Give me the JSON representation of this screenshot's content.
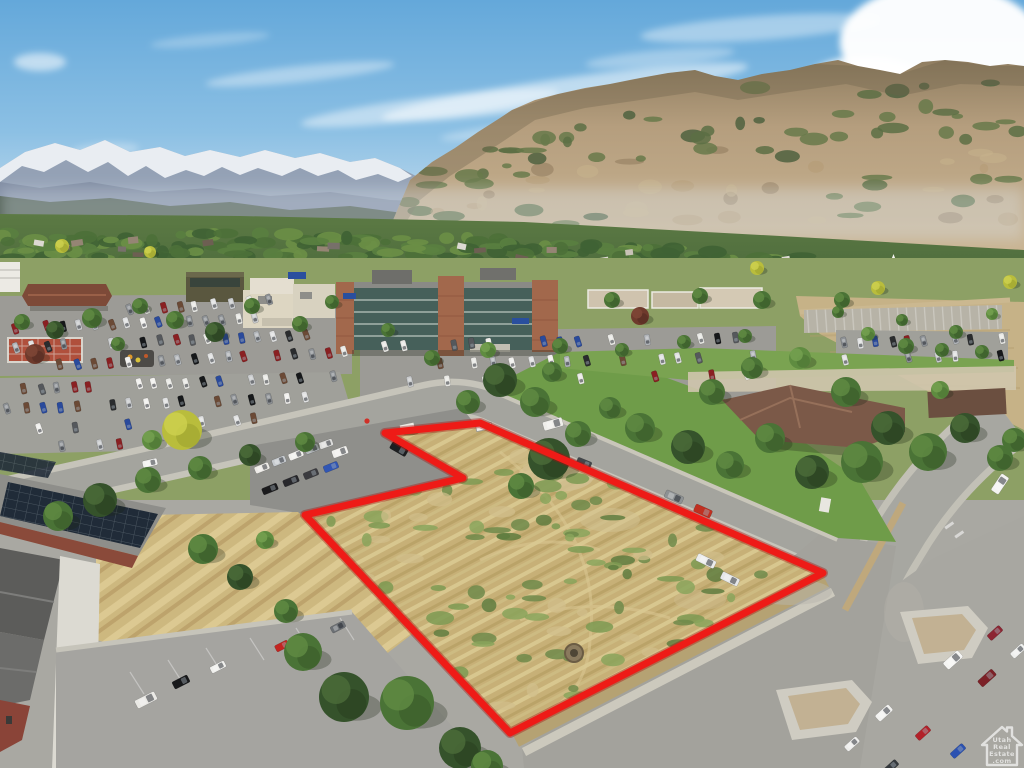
{
  "scene": {
    "kind": "aerial-drone-real-estate-photo",
    "boundary": {
      "color": "#ee1b17",
      "under_color": "#a51210",
      "stroke_width": 7,
      "points_str": "385,433 480,423 823,573 510,733 305,515 463,478"
    },
    "watermark": {
      "icon": "mls-house-watermark-icon",
      "lines": [
        "Utah",
        "Real",
        "Estate",
        ".com"
      ],
      "color": "#ffffff",
      "opacity": 0.66
    },
    "palette": {
      "sky_top": "#64a8da",
      "sky_horizon": "#cfe2ef",
      "cloud": "#ffffff",
      "snow": "#edf1f6",
      "rock_far": "#94a1b5",
      "forest_base": "#4b5a4e",
      "mtn_tan_hi": "#c9b492",
      "mtn_tan_lo": "#9b8466",
      "mtn_green": "#5f7247",
      "valley_green": "#4e6c3c",
      "lawn": "#6f9c49",
      "pavement": "#a5a4a0",
      "pavement_dark": "#8f8f8b",
      "sidewalk": "#cac8bc",
      "field_tan": "#c6b287",
      "parcel_tan": "#c7b077",
      "brick": "#a2684c",
      "beige": "#ddd6c2",
      "glass": "#46605a",
      "roof_brown": "#7b5948",
      "solar": "#202b38",
      "brick_red": "#8a4a3a",
      "plaza_red": "#b0503c",
      "boundary_red": "#ee1b17"
    },
    "clouds": [
      {
        "x": 300,
        "y": 74,
        "rx": 95,
        "ry": 8,
        "o": 0.38,
        "rot": -6
      },
      {
        "x": 430,
        "y": 108,
        "rx": 130,
        "ry": 11,
        "o": 0.45,
        "rot": -7
      },
      {
        "x": 565,
        "y": 92,
        "rx": 185,
        "ry": 14,
        "o": 0.5,
        "rot": -8
      },
      {
        "x": 660,
        "y": 58,
        "rx": 75,
        "ry": 8,
        "o": 0.32,
        "rot": -5
      },
      {
        "x": 520,
        "y": 130,
        "rx": 80,
        "ry": 7,
        "o": 0.3,
        "rot": -6
      },
      {
        "x": 760,
        "y": 28,
        "rx": 120,
        "ry": 12,
        "o": 0.4,
        "rot": -4
      },
      {
        "x": 40,
        "y": 62,
        "rx": 26,
        "ry": 9,
        "o": 0.55,
        "rot": 0
      },
      {
        "x": 105,
        "y": 150,
        "rx": 34,
        "ry": 7,
        "o": 0.28,
        "rot": -4
      },
      {
        "x": 210,
        "y": 40,
        "rx": 60,
        "ry": 6,
        "o": 0.25,
        "rot": -5
      },
      {
        "x": 940,
        "y": 42,
        "rx": 100,
        "ry": 58,
        "o": 0.97,
        "rot": 0
      },
      {
        "x": 866,
        "y": 98,
        "rx": 72,
        "ry": 42,
        "o": 0.92,
        "rot": 0
      },
      {
        "x": 1002,
        "y": 112,
        "rx": 64,
        "ry": 38,
        "o": 0.9,
        "rot": 0
      },
      {
        "x": 918,
        "y": 136,
        "rx": 84,
        "ry": 30,
        "o": 0.85,
        "rot": 0
      },
      {
        "x": 760,
        "y": 150,
        "rx": 60,
        "ry": 9,
        "o": 0.22,
        "rot": -4
      }
    ],
    "valley": {
      "seed": 7,
      "clump_count": 240,
      "roof_count": 26
    },
    "mountain_texture": {
      "seed": 11,
      "count": 95
    },
    "parcel_scrub": {
      "seed": 5,
      "count": 95
    },
    "parking_lots": [
      {
        "seed": 3,
        "fill": 0.8,
        "len": 11,
        "wid": 5.5,
        "slant": -14,
        "rows": [
          [
            15,
            328,
            255,
            318,
            16
          ],
          [
            15,
            347,
            305,
            335,
            19
          ],
          [
            60,
            365,
            345,
            352,
            18
          ],
          [
            130,
            310,
            180,
            306,
            4
          ],
          [
            195,
            306,
            268,
            300,
            5
          ]
        ]
      },
      {
        "seed": 8,
        "fill": 0.75,
        "len": 11,
        "wid": 5.5,
        "slant": -12,
        "rows": [
          [
            25,
            389,
            332,
            377,
            20
          ],
          [
            8,
            409,
            305,
            397,
            18
          ],
          [
            40,
            429,
            255,
            419,
            13
          ],
          [
            2,
            449,
            120,
            443,
            7
          ]
        ]
      },
      {
        "seed": 13,
        "fill": 0.55,
        "len": 11,
        "wid": 5.5,
        "slant": -12,
        "rows": [
          [
            385,
            346,
            752,
            337,
            22
          ],
          [
            420,
            364,
            772,
            356,
            20
          ],
          [
            392,
            383,
            748,
            375,
            20
          ]
        ]
      },
      {
        "seed": 21,
        "fill": 0.62,
        "len": 11,
        "wid": 5.5,
        "slant": -10,
        "rows": [
          [
            845,
            343,
            1002,
            338,
            11
          ],
          [
            845,
            359,
            1002,
            355,
            11
          ]
        ]
      }
    ],
    "vehicles": [
      {
        "x": 262,
        "y": 468,
        "a": -22,
        "l": 15,
        "w": 7,
        "c": "#eceae6"
      },
      {
        "x": 279,
        "y": 461,
        "a": -22,
        "l": 14,
        "w": 7,
        "c": "#c6cace"
      },
      {
        "x": 296,
        "y": 455,
        "a": -22,
        "l": 15,
        "w": 7,
        "c": "#f0efec"
      },
      {
        "x": 312,
        "y": 449,
        "a": -22,
        "l": 14,
        "w": 7,
        "c": "#b4b8bc"
      },
      {
        "x": 326,
        "y": 444,
        "a": -20,
        "l": 14,
        "w": 7,
        "c": "#dddddb"
      },
      {
        "x": 340,
        "y": 452,
        "a": -20,
        "l": 16,
        "w": 8,
        "c": "#f1f0ed"
      },
      {
        "x": 270,
        "y": 489,
        "a": -22,
        "l": 16,
        "w": 7,
        "c": "#1b1b1d"
      },
      {
        "x": 291,
        "y": 481,
        "a": -22,
        "l": 16,
        "w": 7,
        "c": "#28282c"
      },
      {
        "x": 311,
        "y": 474,
        "a": -22,
        "l": 15,
        "w": 7,
        "c": "#3b3b3f"
      },
      {
        "x": 331,
        "y": 467,
        "a": -22,
        "l": 15,
        "w": 7,
        "c": "#3156b4"
      },
      {
        "x": 399,
        "y": 449,
        "a": 30,
        "l": 18,
        "w": 8,
        "c": "#1d1f21"
      },
      {
        "x": 553,
        "y": 424,
        "a": -16,
        "l": 20,
        "w": 9,
        "c": "#efeeea"
      },
      {
        "x": 584,
        "y": 463,
        "a": 22,
        "l": 15,
        "w": 7,
        "c": "#43474b"
      },
      {
        "x": 674,
        "y": 497,
        "a": 24,
        "l": 19,
        "w": 8,
        "c": "#8d9193"
      },
      {
        "x": 703,
        "y": 511,
        "a": 24,
        "l": 18,
        "w": 8,
        "c": "#c03021"
      },
      {
        "x": 706,
        "y": 561,
        "a": 26,
        "l": 20,
        "w": 8,
        "c": "#ebecec"
      },
      {
        "x": 730,
        "y": 579,
        "a": 26,
        "l": 19,
        "w": 8,
        "c": "#e6e8e9"
      },
      {
        "x": 150,
        "y": 463,
        "a": -13,
        "l": 15,
        "w": 7,
        "c": "#f2f2f0"
      },
      {
        "x": 1000,
        "y": 484,
        "a": -56,
        "l": 20,
        "w": 9,
        "c": "#f3f3f1"
      },
      {
        "x": 995,
        "y": 633,
        "a": -42,
        "l": 16,
        "w": 7,
        "c": "#8c2532"
      },
      {
        "x": 1018,
        "y": 651,
        "a": -42,
        "l": 16,
        "w": 7,
        "c": "#eff0ee"
      },
      {
        "x": 953,
        "y": 660,
        "a": -42,
        "l": 20,
        "w": 9,
        "c": "#f5f5f3"
      },
      {
        "x": 987,
        "y": 678,
        "a": -42,
        "l": 19,
        "w": 8,
        "c": "#7c2127"
      },
      {
        "x": 884,
        "y": 713,
        "a": -42,
        "l": 18,
        "w": 8,
        "c": "#f2f2f0"
      },
      {
        "x": 852,
        "y": 744,
        "a": -42,
        "l": 16,
        "w": 7,
        "c": "#ededeb"
      },
      {
        "x": 923,
        "y": 733,
        "a": -42,
        "l": 16,
        "w": 7,
        "c": "#b22129"
      },
      {
        "x": 958,
        "y": 751,
        "a": -42,
        "l": 16,
        "w": 7,
        "c": "#2b51b1"
      },
      {
        "x": 891,
        "y": 767,
        "a": -42,
        "l": 16,
        "w": 7,
        "c": "#34383c"
      },
      {
        "x": 146,
        "y": 700,
        "a": -27,
        "l": 22,
        "w": 9,
        "c": "#eae9e5"
      },
      {
        "x": 181,
        "y": 682,
        "a": -27,
        "l": 17,
        "w": 8,
        "c": "#18191b"
      },
      {
        "x": 218,
        "y": 667,
        "a": -27,
        "l": 16,
        "w": 7,
        "c": "#f0f0ed"
      },
      {
        "x": 282,
        "y": 646,
        "a": -27,
        "l": 14,
        "w": 7,
        "c": "#c32521"
      },
      {
        "x": 338,
        "y": 627,
        "a": -27,
        "l": 15,
        "w": 7,
        "c": "#6c7074"
      }
    ],
    "trees": [
      {
        "x": 58,
        "y": 516,
        "r": 15,
        "t": "m"
      },
      {
        "x": 100,
        "y": 500,
        "r": 17,
        "t": "d"
      },
      {
        "x": 148,
        "y": 480,
        "r": 13,
        "t": "m"
      },
      {
        "x": 200,
        "y": 468,
        "r": 12,
        "t": "m"
      },
      {
        "x": 250,
        "y": 455,
        "r": 11,
        "t": "d"
      },
      {
        "x": 305,
        "y": 442,
        "r": 10,
        "t": "m"
      },
      {
        "x": 182,
        "y": 430,
        "r": 20,
        "t": "y"
      },
      {
        "x": 152,
        "y": 440,
        "r": 10,
        "t": "l"
      },
      {
        "x": 500,
        "y": 380,
        "r": 17,
        "t": "d"
      },
      {
        "x": 535,
        "y": 402,
        "r": 15,
        "t": "m"
      },
      {
        "x": 468,
        "y": 402,
        "r": 12,
        "t": "m"
      },
      {
        "x": 552,
        "y": 372,
        "r": 10,
        "t": "m"
      },
      {
        "x": 549,
        "y": 459,
        "r": 21,
        "t": "d"
      },
      {
        "x": 521,
        "y": 486,
        "r": 13,
        "t": "m"
      },
      {
        "x": 578,
        "y": 434,
        "r": 13,
        "t": "m"
      },
      {
        "x": 303,
        "y": 652,
        "r": 19,
        "t": "m"
      },
      {
        "x": 344,
        "y": 697,
        "r": 25,
        "t": "d"
      },
      {
        "x": 407,
        "y": 703,
        "r": 27,
        "t": "m"
      },
      {
        "x": 460,
        "y": 748,
        "r": 21,
        "t": "d"
      },
      {
        "x": 487,
        "y": 766,
        "r": 16,
        "t": "m"
      },
      {
        "x": 286,
        "y": 611,
        "r": 12,
        "t": "m"
      },
      {
        "x": 203,
        "y": 549,
        "r": 15,
        "t": "m"
      },
      {
        "x": 240,
        "y": 577,
        "r": 13,
        "t": "d"
      },
      {
        "x": 265,
        "y": 540,
        "r": 9,
        "t": "l"
      },
      {
        "x": 640,
        "y": 428,
        "r": 15,
        "t": "m"
      },
      {
        "x": 688,
        "y": 447,
        "r": 17,
        "t": "d"
      },
      {
        "x": 730,
        "y": 465,
        "r": 14,
        "t": "m"
      },
      {
        "x": 610,
        "y": 408,
        "r": 11,
        "t": "m"
      },
      {
        "x": 712,
        "y": 392,
        "r": 13,
        "t": "m"
      },
      {
        "x": 752,
        "y": 368,
        "r": 11,
        "t": "m"
      },
      {
        "x": 800,
        "y": 358,
        "r": 11,
        "t": "l"
      },
      {
        "x": 846,
        "y": 392,
        "r": 15,
        "t": "m"
      },
      {
        "x": 888,
        "y": 428,
        "r": 17,
        "t": "d"
      },
      {
        "x": 928,
        "y": 452,
        "r": 19,
        "t": "m"
      },
      {
        "x": 965,
        "y": 428,
        "r": 15,
        "t": "d"
      },
      {
        "x": 1000,
        "y": 458,
        "r": 13,
        "t": "m"
      },
      {
        "x": 862,
        "y": 462,
        "r": 21,
        "t": "m"
      },
      {
        "x": 812,
        "y": 472,
        "r": 17,
        "t": "d"
      },
      {
        "x": 770,
        "y": 438,
        "r": 15,
        "t": "m"
      },
      {
        "x": 940,
        "y": 390,
        "r": 9,
        "t": "l"
      },
      {
        "x": 906,
        "y": 346,
        "r": 8,
        "t": "m"
      },
      {
        "x": 942,
        "y": 350,
        "r": 7,
        "t": "m"
      },
      {
        "x": 982,
        "y": 352,
        "r": 7,
        "t": "m"
      },
      {
        "x": 1014,
        "y": 440,
        "r": 12,
        "t": "m"
      },
      {
        "x": 432,
        "y": 358,
        "r": 8,
        "t": "m"
      },
      {
        "x": 488,
        "y": 350,
        "r": 8,
        "t": "l"
      },
      {
        "x": 560,
        "y": 346,
        "r": 8,
        "t": "m"
      },
      {
        "x": 622,
        "y": 350,
        "r": 7,
        "t": "m"
      },
      {
        "x": 684,
        "y": 342,
        "r": 7,
        "t": "m"
      },
      {
        "x": 388,
        "y": 330,
        "r": 7,
        "t": "m"
      },
      {
        "x": 745,
        "y": 336,
        "r": 7,
        "t": "m"
      },
      {
        "x": 215,
        "y": 332,
        "r": 10,
        "t": "d"
      },
      {
        "x": 175,
        "y": 320,
        "r": 9,
        "t": "m"
      },
      {
        "x": 92,
        "y": 318,
        "r": 10,
        "t": "m"
      },
      {
        "x": 55,
        "y": 330,
        "r": 9,
        "t": "d"
      },
      {
        "x": 22,
        "y": 322,
        "r": 8,
        "t": "m"
      },
      {
        "x": 140,
        "y": 306,
        "r": 8,
        "t": "m"
      },
      {
        "x": 252,
        "y": 306,
        "r": 8,
        "t": "m"
      },
      {
        "x": 300,
        "y": 324,
        "r": 8,
        "t": "m"
      },
      {
        "x": 332,
        "y": 302,
        "r": 7,
        "t": "m"
      },
      {
        "x": 35,
        "y": 354,
        "r": 10,
        "t": "r"
      },
      {
        "x": 640,
        "y": 316,
        "r": 9,
        "t": "r"
      },
      {
        "x": 612,
        "y": 300,
        "r": 8,
        "t": "m"
      },
      {
        "x": 700,
        "y": 296,
        "r": 8,
        "t": "m"
      },
      {
        "x": 762,
        "y": 300,
        "r": 9,
        "t": "m"
      },
      {
        "x": 842,
        "y": 300,
        "r": 8,
        "t": "m"
      },
      {
        "x": 118,
        "y": 344,
        "r": 7,
        "t": "m"
      },
      {
        "x": 868,
        "y": 334,
        "r": 7,
        "t": "l"
      },
      {
        "x": 902,
        "y": 320,
        "r": 6,
        "t": "m"
      },
      {
        "x": 956,
        "y": 332,
        "r": 7,
        "t": "m"
      },
      {
        "x": 992,
        "y": 314,
        "r": 6,
        "t": "l"
      },
      {
        "x": 838,
        "y": 312,
        "r": 6,
        "t": "m"
      },
      {
        "x": 757,
        "y": 268,
        "r": 7,
        "t": "y"
      },
      {
        "x": 878,
        "y": 288,
        "r": 7,
        "t": "y"
      },
      {
        "x": 1010,
        "y": 282,
        "r": 7,
        "t": "y"
      },
      {
        "x": 62,
        "y": 246,
        "r": 7,
        "t": "y"
      },
      {
        "x": 150,
        "y": 252,
        "r": 6,
        "t": "y"
      }
    ]
  }
}
